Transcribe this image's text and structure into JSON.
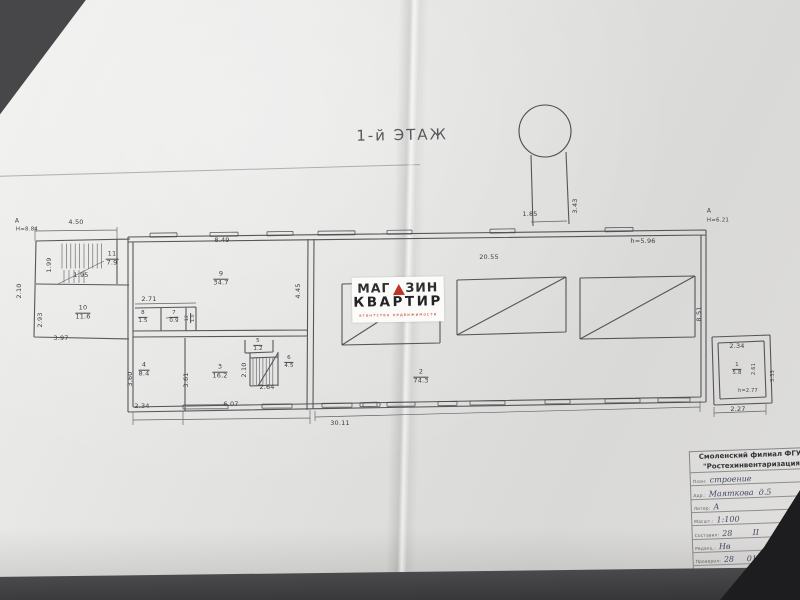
{
  "floor_title": "1-й ЭТАЖ",
  "watermark": {
    "brand_part1": "МАГ",
    "brand_part2": "ЗИН",
    "brand_line2": "КВАРТИР",
    "tagline": "агентство недвижимости",
    "accent_color": "#c03427"
  },
  "plan_labels": [
    {
      "name": "marker-a-left",
      "text": "А",
      "x": 17,
      "y": 221,
      "size": 6
    },
    {
      "name": "height-left",
      "text": "Н=8.84",
      "x": 27,
      "y": 230,
      "size": 5.5
    },
    {
      "name": "dim-4-50",
      "text": "4.50",
      "x": 76,
      "y": 223
    },
    {
      "name": "room-11",
      "text": "11\n7.9",
      "x": 112,
      "y": 259,
      "frac": true
    },
    {
      "name": "dim-1-99",
      "text": "1.99",
      "x": 50,
      "y": 265,
      "rot": true
    },
    {
      "name": "dim-1-95",
      "text": "1.95",
      "x": 81,
      "y": 276
    },
    {
      "name": "dim-2-10-left",
      "text": "2.10",
      "x": 20,
      "y": 291,
      "rot": true
    },
    {
      "name": "room-10",
      "text": "10\n11.6",
      "x": 83,
      "y": 313,
      "frac": true
    },
    {
      "name": "dim-2-93",
      "text": "2.93",
      "x": 41,
      "y": 320,
      "rot": true
    },
    {
      "name": "dim-3-97",
      "text": "3.97",
      "x": 61,
      "y": 339
    },
    {
      "name": "dim-8-49",
      "text": "8.49",
      "x": 222,
      "y": 241
    },
    {
      "name": "room-9",
      "text": "9\n34.7",
      "x": 221,
      "y": 279,
      "frac": true
    },
    {
      "name": "dim-4-45",
      "text": "4.45",
      "x": 299,
      "y": 291,
      "rot": true
    },
    {
      "name": "dim-2-71",
      "text": "2.71",
      "x": 149,
      "y": 300
    },
    {
      "name": "room-8",
      "text": "8\n1.5",
      "x": 143,
      "y": 317,
      "frac": true,
      "size": 5.5
    },
    {
      "name": "room-7",
      "text": "7\n0.9",
      "x": 174,
      "y": 317,
      "frac": true,
      "size": 5.5
    },
    {
      "name": "room-12",
      "text": "12\n1.0",
      "x": 191,
      "y": 318,
      "rot": true,
      "frac": true,
      "size": 4.5
    },
    {
      "name": "room-4",
      "text": "4\n8.4",
      "x": 144,
      "y": 370,
      "frac": true
    },
    {
      "name": "dim-3-60",
      "text": "3.60",
      "x": 131,
      "y": 379,
      "rot": true
    },
    {
      "name": "dim-2-34-left",
      "text": "2.34",
      "x": 142,
      "y": 407
    },
    {
      "name": "dim-3-61",
      "text": "3.61",
      "x": 187,
      "y": 380,
      "rot": true
    },
    {
      "name": "room-3",
      "text": "3\n16.2",
      "x": 220,
      "y": 372,
      "frac": true
    },
    {
      "name": "dim-6-07",
      "text": "6.07",
      "x": 231,
      "y": 405
    },
    {
      "name": "room-5",
      "text": "5\n1.2",
      "x": 258,
      "y": 345,
      "frac": true,
      "size": 5.5
    },
    {
      "name": "dim-2-10-stairs",
      "text": "2.10",
      "x": 245,
      "y": 370,
      "rot": true
    },
    {
      "name": "room-6",
      "text": "6\n4.5",
      "x": 289,
      "y": 362,
      "frac": true,
      "size": 5.5
    },
    {
      "name": "dim-2-64",
      "text": "2.64",
      "x": 267,
      "y": 388
    },
    {
      "name": "room-2",
      "text": "2\n74.3",
      "x": 421,
      "y": 377,
      "frac": true
    },
    {
      "name": "dim-30-11",
      "text": "30.11",
      "x": 340,
      "y": 424
    },
    {
      "name": "dim-20-55",
      "text": "20.55",
      "x": 489,
      "y": 258
    },
    {
      "name": "height-5-96",
      "text": "h=5.96",
      "x": 643,
      "y": 242
    },
    {
      "name": "dim-1-85",
      "text": "1.85",
      "x": 530,
      "y": 215
    },
    {
      "name": "dim-3-43",
      "text": "3.43",
      "x": 576,
      "y": 206,
      "rot": true
    },
    {
      "name": "marker-a-right",
      "text": "А",
      "x": 709,
      "y": 211,
      "size": 6
    },
    {
      "name": "height-6-21",
      "text": "Н=6.21",
      "x": 718,
      "y": 221,
      "size": 5.5
    },
    {
      "name": "dim-8-51",
      "text": "8.51",
      "x": 700,
      "y": 314,
      "rot": true
    },
    {
      "name": "dim-2-34-right",
      "text": "2.34",
      "x": 737,
      "y": 347
    },
    {
      "name": "room-1",
      "text": "1\n5.8",
      "x": 737,
      "y": 369,
      "frac": true,
      "size": 5.5
    },
    {
      "name": "dim-2-61",
      "text": "2.61",
      "x": 754,
      "y": 369,
      "rot": true,
      "size": 5
    },
    {
      "name": "dim-3-33",
      "text": "3.33",
      "x": 773,
      "y": 376,
      "rot": true,
      "size": 5
    },
    {
      "name": "height-2-77",
      "text": "h=2.77",
      "x": 748,
      "y": 391,
      "size": 5
    },
    {
      "name": "dim-2-27",
      "text": "2.27",
      "x": 738,
      "y": 410
    }
  ],
  "title_block": {
    "org_line1": "Смоленский филиал ФГУП",
    "org_line2": "\"Ростехинвентаризация\"",
    "rows": [
      {
        "label": "План:",
        "value": "строение"
      },
      {
        "label": "Адр.:",
        "value": "Маяткова  д.5"
      },
      {
        "label": "Литер:",
        "value": "А"
      },
      {
        "label": "Масшт.:",
        "value": "1:100"
      },
      {
        "label": "Составил:",
        "value": "28        II"
      },
      {
        "label": "Редакц.:",
        "value": "Нв"
      },
      {
        "label": "Проверил:",
        "value": "28     01"
      },
      {
        "label": "Подпись:",
        "value": "Гол.  (Галочкина)"
      }
    ]
  }
}
